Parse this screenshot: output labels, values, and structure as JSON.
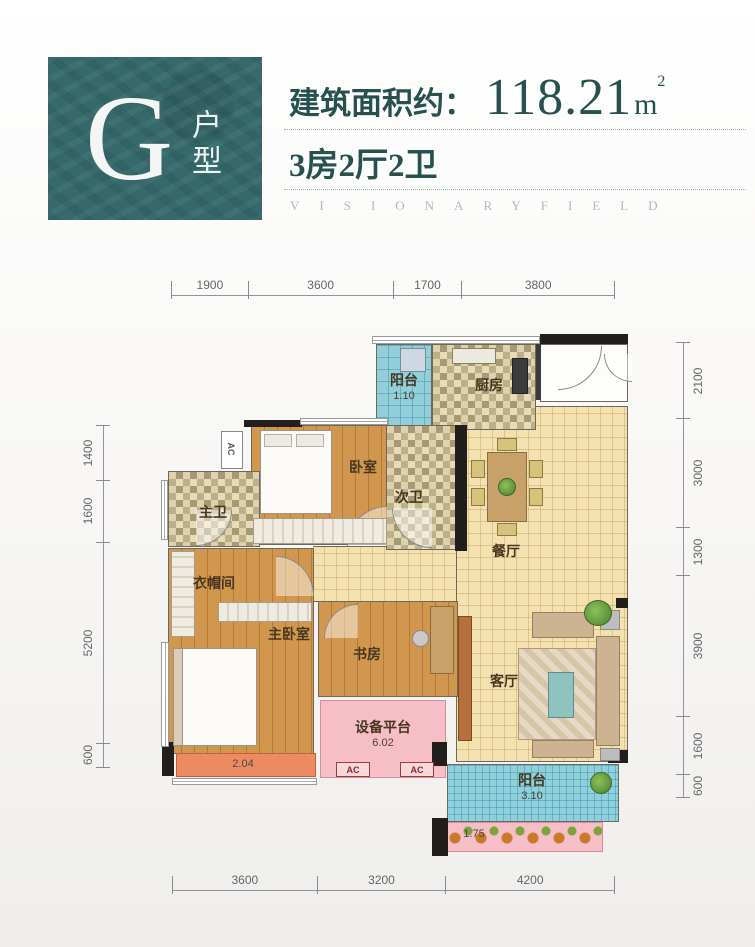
{
  "header": {
    "unit_letter": "G",
    "unit_suffix": "户型",
    "area_prefix": "建筑面积约：",
    "area_value": "118.21",
    "area_unit_base": "m",
    "area_unit_sup": "2",
    "rooms_summary": "3房2厅2卫",
    "watermark": "VISIONARYFIELD"
  },
  "rooms": {
    "balcony_top": {
      "name": "阳台",
      "area": "1.10"
    },
    "kitchen": {
      "name": "厨房"
    },
    "bedroom": {
      "name": "卧室"
    },
    "second_bath": {
      "name": "次卫"
    },
    "master_bath": {
      "name": "主卫"
    },
    "cloakroom": {
      "name": "衣帽间"
    },
    "master_bedroom": {
      "name": "主卧室"
    },
    "study": {
      "name": "书房"
    },
    "dining": {
      "name": "餐厅"
    },
    "living": {
      "name": "客厅"
    },
    "equipment": {
      "name": "设备平台",
      "area": "6.02"
    },
    "balcony_bottom": {
      "name": "阳台",
      "area": "3.10"
    },
    "bay_window": {
      "area": "2.04"
    },
    "flower_bed": {
      "area": "1.75"
    }
  },
  "labels": {
    "ac": "AC"
  },
  "dimensions": {
    "top": [
      1900,
      3600,
      1700,
      3800
    ],
    "bottom": [
      3600,
      3200,
      4200
    ],
    "left": [
      1400,
      1600,
      5200,
      600
    ],
    "right": [
      2100,
      3000,
      1300,
      3900,
      1600,
      600
    ]
  },
  "colors": {
    "brand_teal": "#35696b",
    "heading_text": "#27514e",
    "tile_tan": "#f4e1b0",
    "wood_floor": "#d1974e",
    "balcony_blue": "#93cfdb",
    "platform_pink": "#f6bfc7",
    "bay_orange": "#ec8a61",
    "wall_black": "#211e1b"
  }
}
